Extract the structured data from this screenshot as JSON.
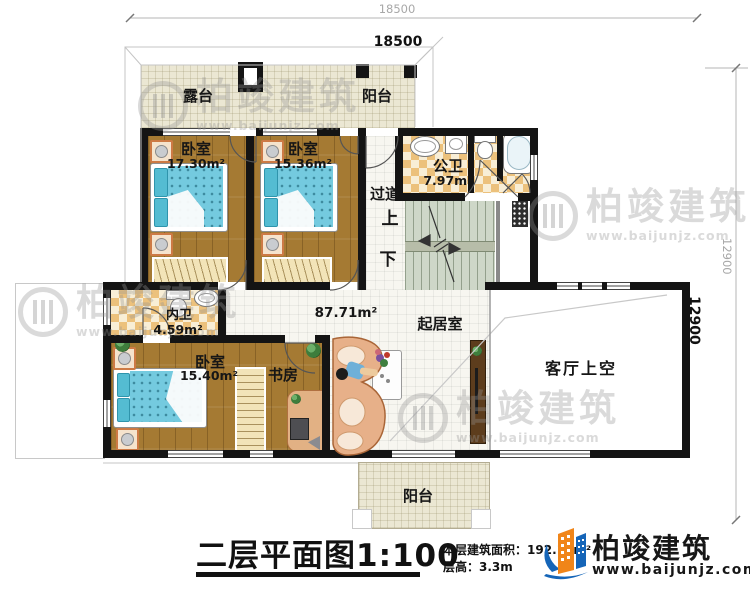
{
  "dimensions": {
    "width_outer": "18500",
    "width_inner": "18500",
    "height_outer": "12900",
    "height_inner": "12900"
  },
  "rooms": {
    "terrace": {
      "name": "露台"
    },
    "balcony_top": {
      "name": "阳台"
    },
    "bedroom1": {
      "name": "卧室",
      "area": "17.30m²"
    },
    "bedroom2": {
      "name": "卧室",
      "area": "15.36m²"
    },
    "public_bath": {
      "name": "公卫",
      "area": "7.97m²"
    },
    "corridor": {
      "name": "过道"
    },
    "stairs": {
      "up": "上",
      "down": "下"
    },
    "private_bath": {
      "name": "内卫",
      "area": "4.59m²"
    },
    "bedroom3": {
      "name": "卧室",
      "area": "15.40m²"
    },
    "study": {
      "name": "书房"
    },
    "living": {
      "name": "起居室",
      "area": "87.71m²"
    },
    "void": {
      "name": "客厅上空"
    },
    "balcony_bottom": {
      "name": "阳台"
    }
  },
  "title_block": {
    "title": "二层平面图1:100",
    "floor_area_label": "本层建筑面积：",
    "floor_area_value": "192.16m²",
    "floor_height_label": "层高：",
    "floor_height_value": "3.3m"
  },
  "logo": {
    "name": "柏竣建筑",
    "url": "www.baijunjz.com"
  },
  "watermark": {
    "name": "柏竣建筑",
    "url": "www.baijunjz.com"
  },
  "colors": {
    "wall": "#141414",
    "wood_floor": "#a57a33",
    "terrace_floor": "#ebe7d3",
    "stair_floor": "#ced7c8",
    "bed_blue": "#74cadf",
    "sofa_tan": "#e7b089",
    "logo_blue": "#1565b8",
    "logo_orange": "#f08519"
  }
}
